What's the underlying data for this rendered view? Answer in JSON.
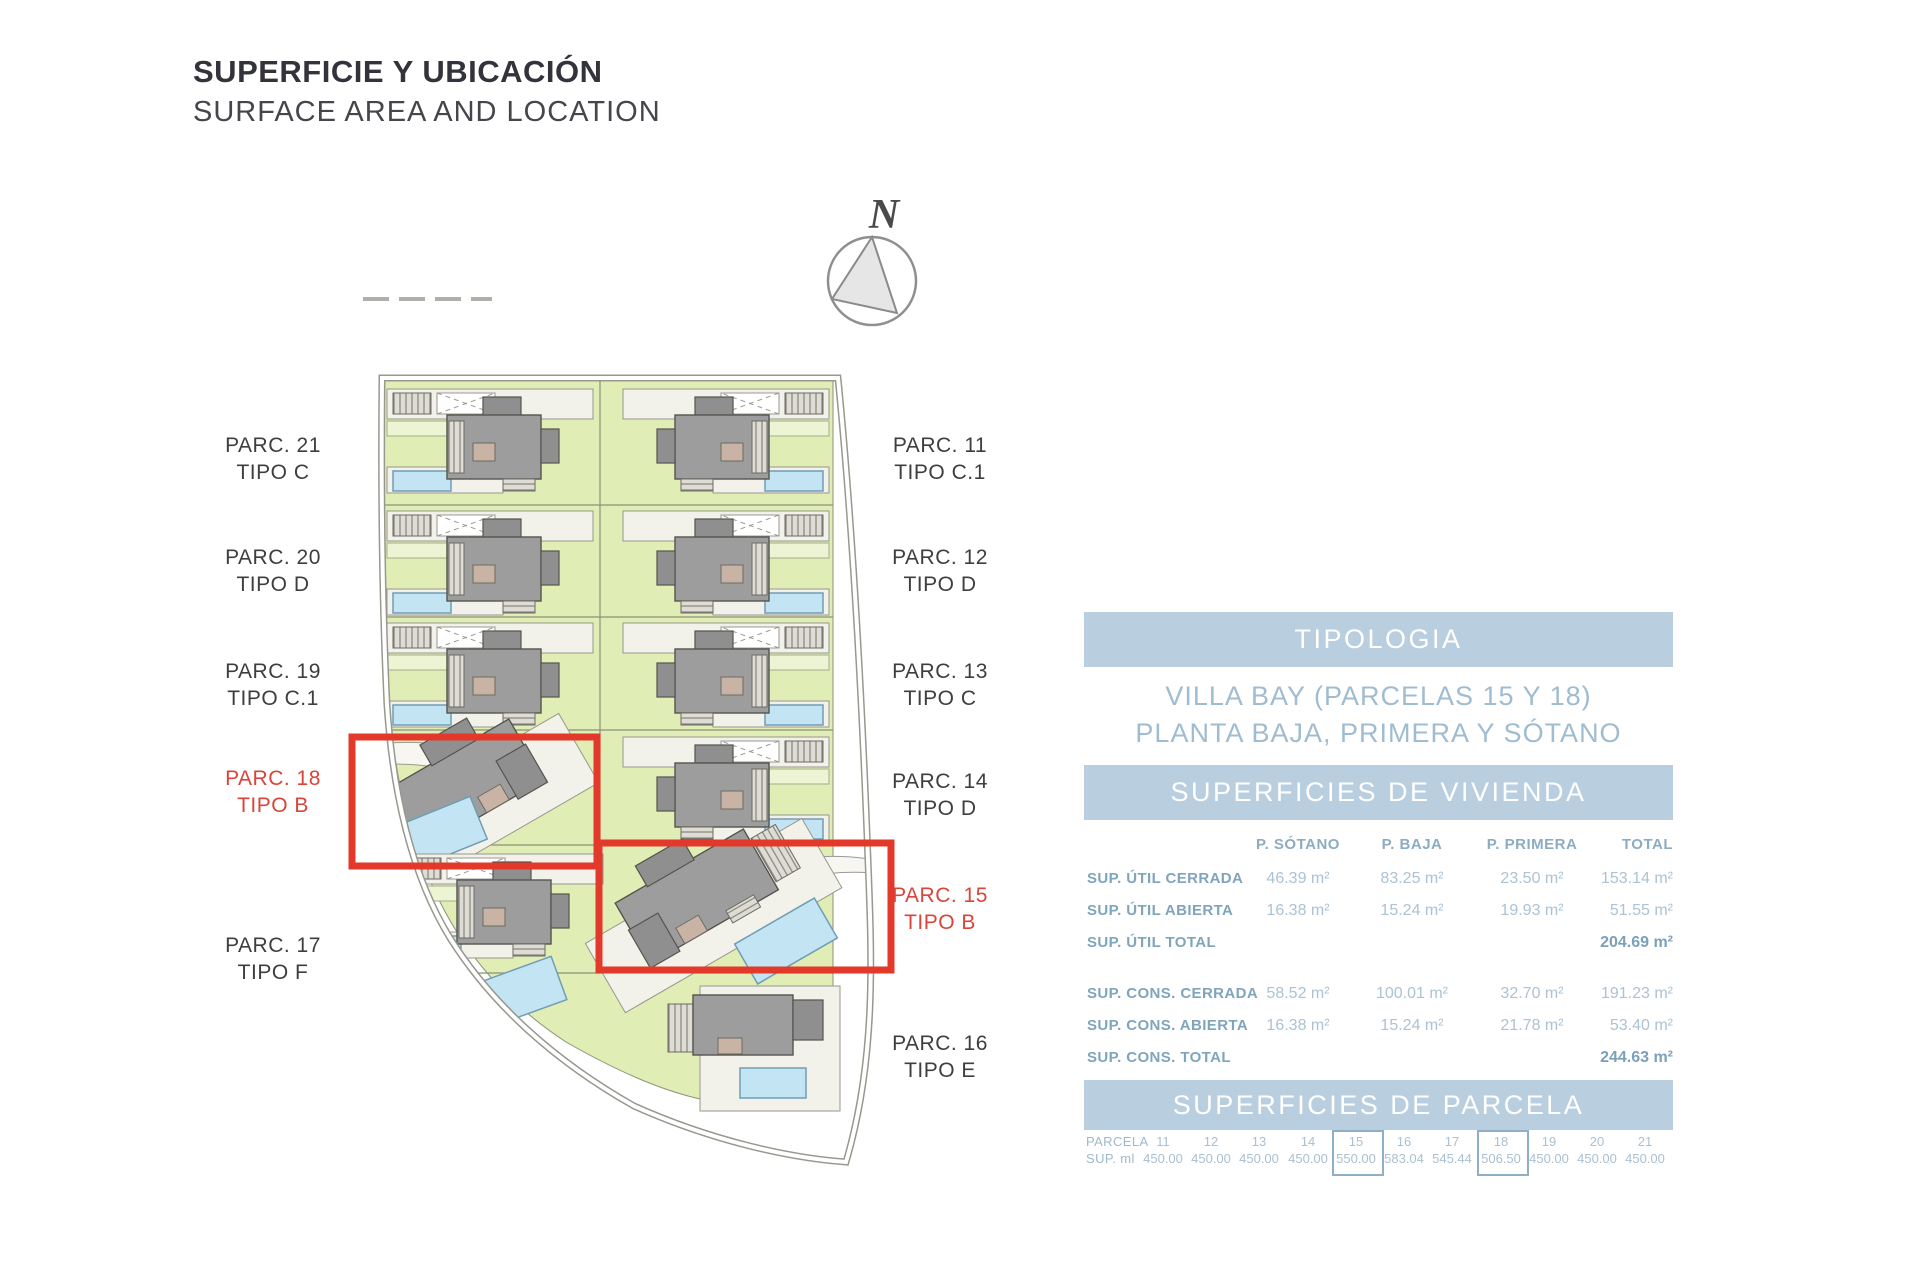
{
  "header": {
    "title": "SUPERFICIE Y UBICACIÓN",
    "subtitle": "SURFACE AREA AND LOCATION"
  },
  "compass": {
    "label": "N"
  },
  "site_plan": {
    "parcel_labels_left": [
      {
        "parcel": "PARC. 21",
        "tipo": "TIPO C",
        "highlight": false
      },
      {
        "parcel": "PARC. 20",
        "tipo": "TIPO D",
        "highlight": false
      },
      {
        "parcel": "PARC. 19",
        "tipo": "TIPO C.1",
        "highlight": false
      },
      {
        "parcel": "PARC. 18",
        "tipo": "TIPO B",
        "highlight": true
      },
      {
        "parcel": "PARC. 17",
        "tipo": "TIPO F",
        "highlight": false
      }
    ],
    "parcel_labels_right": [
      {
        "parcel": "PARC. 11",
        "tipo": "TIPO C.1",
        "highlight": false
      },
      {
        "parcel": "PARC. 12",
        "tipo": "TIPO D",
        "highlight": false
      },
      {
        "parcel": "PARC. 13",
        "tipo": "TIPO C",
        "highlight": false
      },
      {
        "parcel": "PARC. 14",
        "tipo": "TIPO D",
        "highlight": false
      },
      {
        "parcel": "PARC. 15",
        "tipo": "TIPO B",
        "highlight": true
      },
      {
        "parcel": "PARC. 16",
        "tipo": "TIPO E",
        "highlight": false
      }
    ],
    "colors": {
      "highlight_red": "#e2392b",
      "parcel_green": "#e0edb5",
      "pool_blue": "#c3e5f3",
      "house_grey": "#9d9d9d",
      "terrace": "#f2f1ea"
    }
  },
  "tipologia": {
    "header": "TIPOLOGIA",
    "line1": "VILLA BAY (PARCELAS 15 Y 18)",
    "line2": "PLANTA BAJA, PRIMERA Y SÓTANO"
  },
  "vivienda": {
    "header": "SUPERFICIES DE VIVIENDA",
    "columns": [
      "P. SÓTANO",
      "P. BAJA",
      "P. PRIMERA",
      "TOTAL"
    ],
    "rows": [
      {
        "label": "SUP. ÚTIL CERRADA",
        "values": [
          "46.39 m²",
          "83.25 m²",
          "23.50 m²",
          "153.14 m²"
        ]
      },
      {
        "label": "SUP. ÚTIL ABIERTA",
        "values": [
          "16.38 m²",
          "15.24 m²",
          "19.93 m²",
          "51.55 m²"
        ]
      },
      {
        "label": "SUP. ÚTIL TOTAL",
        "values": [
          "",
          "",
          "",
          "204.69 m²"
        ]
      },
      {
        "label": "SUP. CONS. CERRADA",
        "values": [
          "58.52 m²",
          "100.01 m²",
          "32.70 m²",
          "191.23 m²"
        ]
      },
      {
        "label": "SUP. CONS. ABIERTA",
        "values": [
          "16.38 m²",
          "15.24 m²",
          "21.78 m²",
          "53.40 m²"
        ]
      },
      {
        "label": "SUP. CONS. TOTAL",
        "values": [
          "",
          "",
          "",
          "244.63 m²"
        ]
      }
    ],
    "accent_color": "#b9cfdf"
  },
  "parcela": {
    "header": "SUPERFICIES DE PARCELA",
    "row_labels": [
      "PARCELA",
      "SUP. ml"
    ],
    "columns": [
      {
        "num": "11",
        "sup": "450.00",
        "boxed": false
      },
      {
        "num": "12",
        "sup": "450.00",
        "boxed": false
      },
      {
        "num": "13",
        "sup": "450.00",
        "boxed": false
      },
      {
        "num": "14",
        "sup": "450.00",
        "boxed": false
      },
      {
        "num": "15",
        "sup": "550.00",
        "boxed": true
      },
      {
        "num": "16",
        "sup": "583.04",
        "boxed": false
      },
      {
        "num": "17",
        "sup": "545.44",
        "boxed": false
      },
      {
        "num": "18",
        "sup": "506.50",
        "boxed": true
      },
      {
        "num": "19",
        "sup": "450.00",
        "boxed": false
      },
      {
        "num": "20",
        "sup": "450.00",
        "boxed": false
      },
      {
        "num": "21",
        "sup": "450.00",
        "boxed": false
      }
    ]
  }
}
